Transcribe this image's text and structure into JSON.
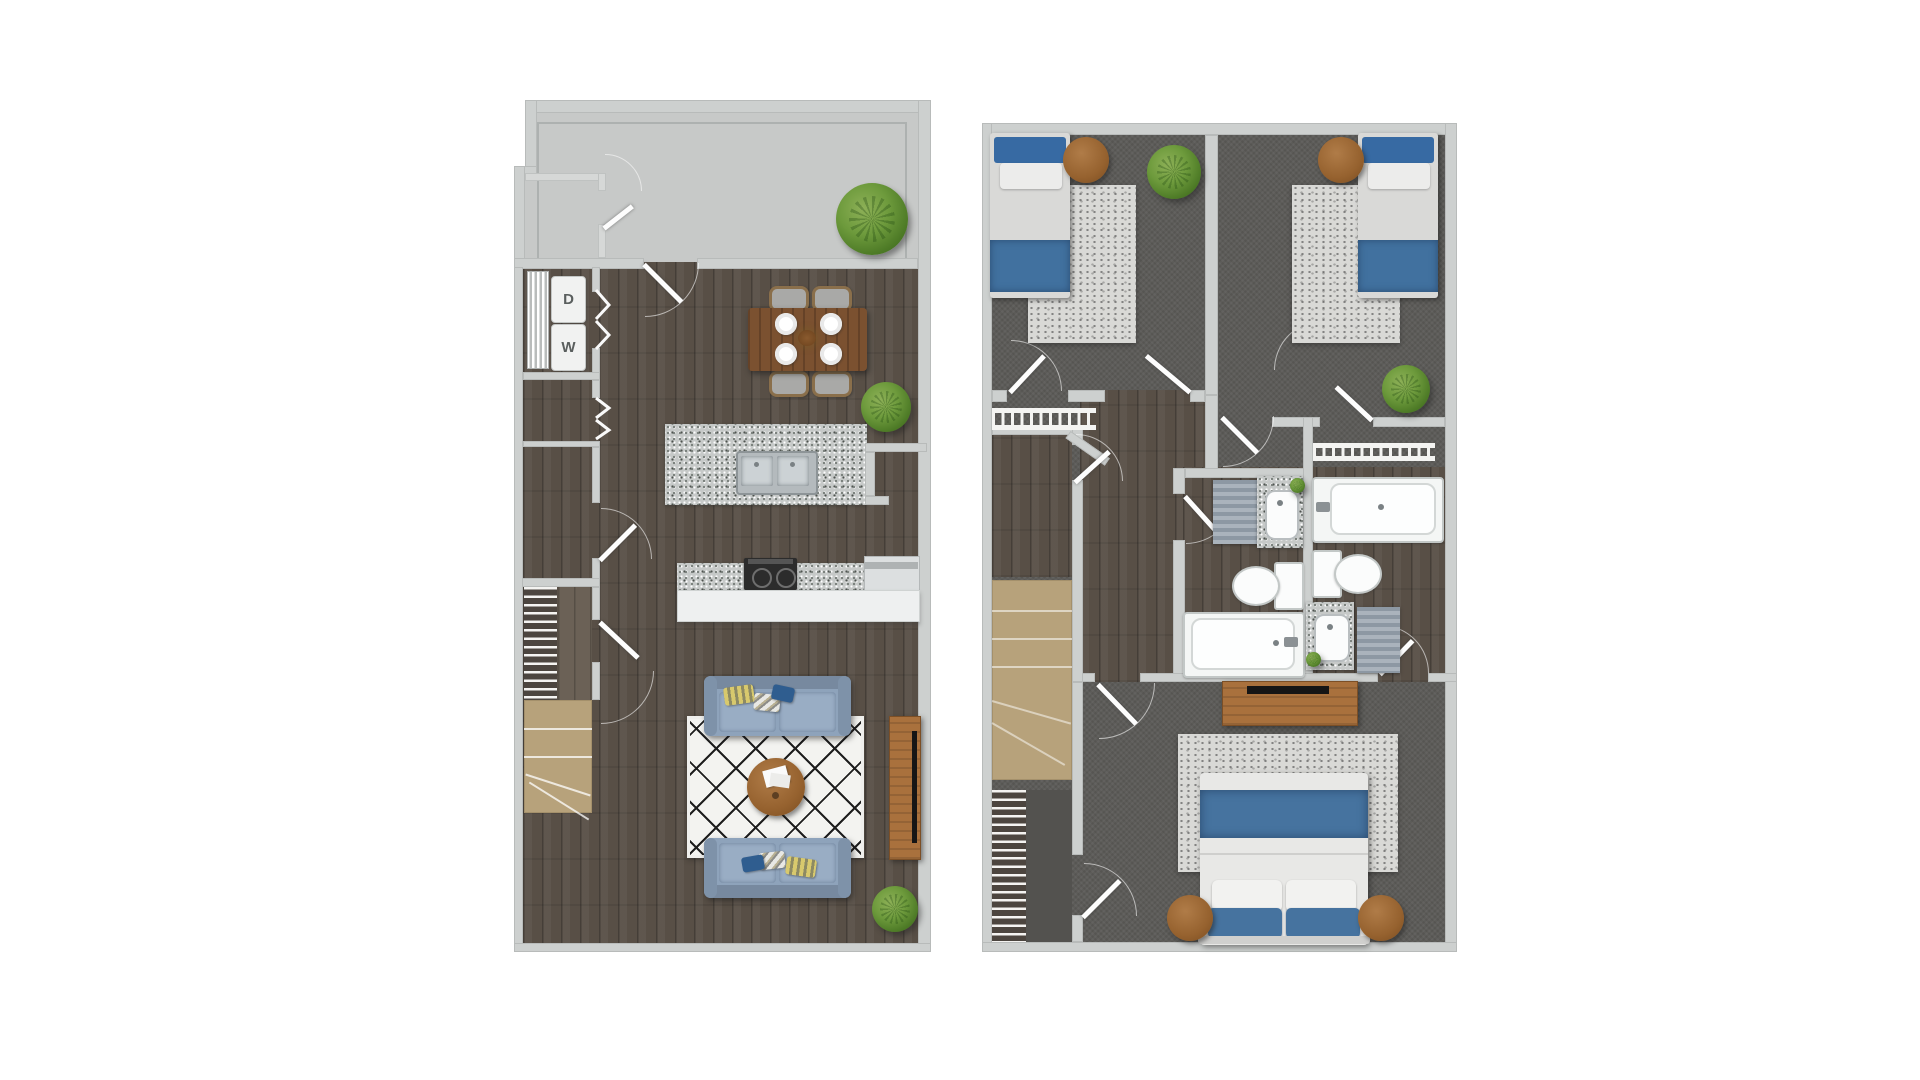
{
  "document": {
    "title": "Townhouse two-level floor plan"
  },
  "first_floor": {
    "name": "first-floor-plan",
    "laundry": {
      "dryer_label": "D",
      "washer_label": "W"
    },
    "areas": [
      "patio",
      "patio-storage",
      "laundry-closet",
      "storage-closet-a",
      "storage-closet-b",
      "kitchen",
      "dining-area",
      "living-room",
      "staircase"
    ],
    "furniture": [
      "stacked-dryer",
      "stacked-washer",
      "dining-table-with-four-chairs-and-plates",
      "kitchen-island-with-double-sink",
      "range-cooktop",
      "refrigerator",
      "two-sofas",
      "diamond-pattern-rug",
      "round-coffee-table",
      "tv-console",
      "three-plants"
    ]
  },
  "second_floor": {
    "name": "second-floor-plan",
    "areas": [
      "bedroom-1",
      "bedroom-2",
      "bedroom-1-closet",
      "bedroom-2-closet",
      "linen-closet",
      "hall-bathroom",
      "master-bathroom",
      "hallway",
      "staircase",
      "master-bedroom"
    ],
    "furniture": [
      "twin-bed-1",
      "twin-bed-2",
      "round-nightstands",
      "area-rugs",
      "two-bathtubs",
      "two-toilets",
      "two-granite-vanities",
      "dresser-with-tv",
      "queen-bed",
      "plants",
      "stair-railing",
      "closet-hanging-rods"
    ]
  },
  "colors": {
    "background": "#ffffff",
    "wall": "#cdd0cf",
    "patio_concrete": "#c7c9c8",
    "wood_floor": "#584f46",
    "carpet": "#5d5c59",
    "stair_tan": "#b7a27b",
    "granite": "#c6c9c8",
    "sofa_blue": "#8ea3bb",
    "bed_blue": "#3d6ca2",
    "plant_green": "#6d9a3c",
    "furniture_wood": "#a9713d"
  }
}
